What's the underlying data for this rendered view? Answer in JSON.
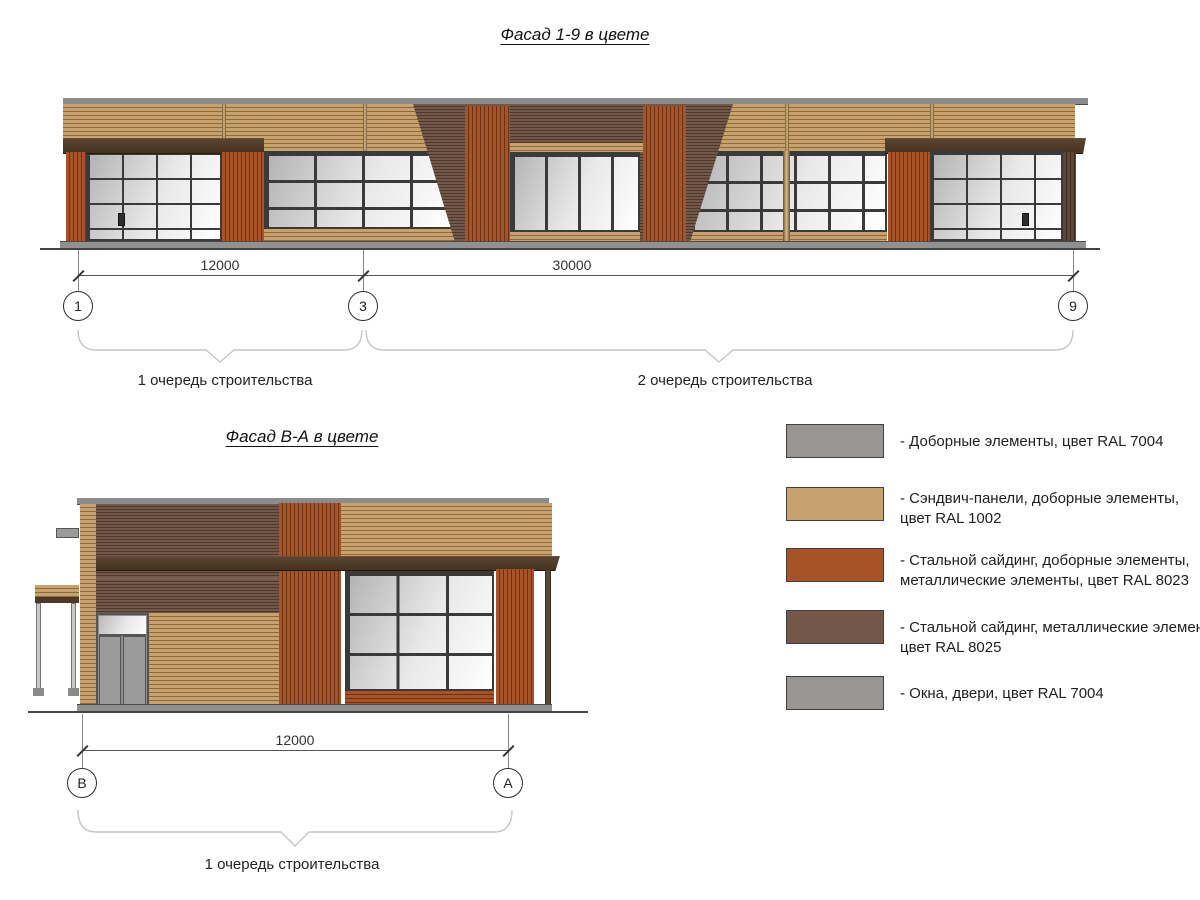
{
  "titles": {
    "facade_1_9": "Фасад 1-9 в цвете",
    "facade_b_a": "Фасад В-А в цвете"
  },
  "facade_1_9": {
    "dimensions": [
      "12000",
      "30000"
    ],
    "grid_axes": [
      "1",
      "3",
      "9"
    ],
    "phases": [
      "1 очередь строительства",
      "2 очередь строительства"
    ]
  },
  "facade_b_a": {
    "dimensions": [
      "12000"
    ],
    "grid_axes": [
      "В",
      "А"
    ],
    "phases": [
      "1 очередь строительства"
    ]
  },
  "legend": {
    "items": [
      {
        "swatch": "#989593",
        "line1": "- Доборные элементы, цвет RAL 7004",
        "line2": ""
      },
      {
        "swatch": "#C8A26C",
        "line1": "- Сэндвич-панели, доборные элементы,",
        "line2": "цвет RAL 1002"
      },
      {
        "swatch": "#A85327",
        "line1": "- Стальной сайдинг, доборные элементы,",
        "line2": "металлические элементы, цвет RAL 8023"
      },
      {
        "swatch": "#73584A",
        "line1": "- Стальной сайдинг, металлические элемен",
        "line2": "цвет RAL 8025"
      },
      {
        "swatch": "#989593",
        "line1": "- Окна, двери, цвет RAL 7004",
        "line2": ""
      }
    ]
  },
  "colors": {
    "ral1002": "#C8A26C",
    "ral8023": "#A85327",
    "ral8025": "#73584A",
    "ral7004": "#989593",
    "mullion": "#3A3A3A",
    "coping": "#8C8C8C",
    "plinth": "#909090"
  }
}
